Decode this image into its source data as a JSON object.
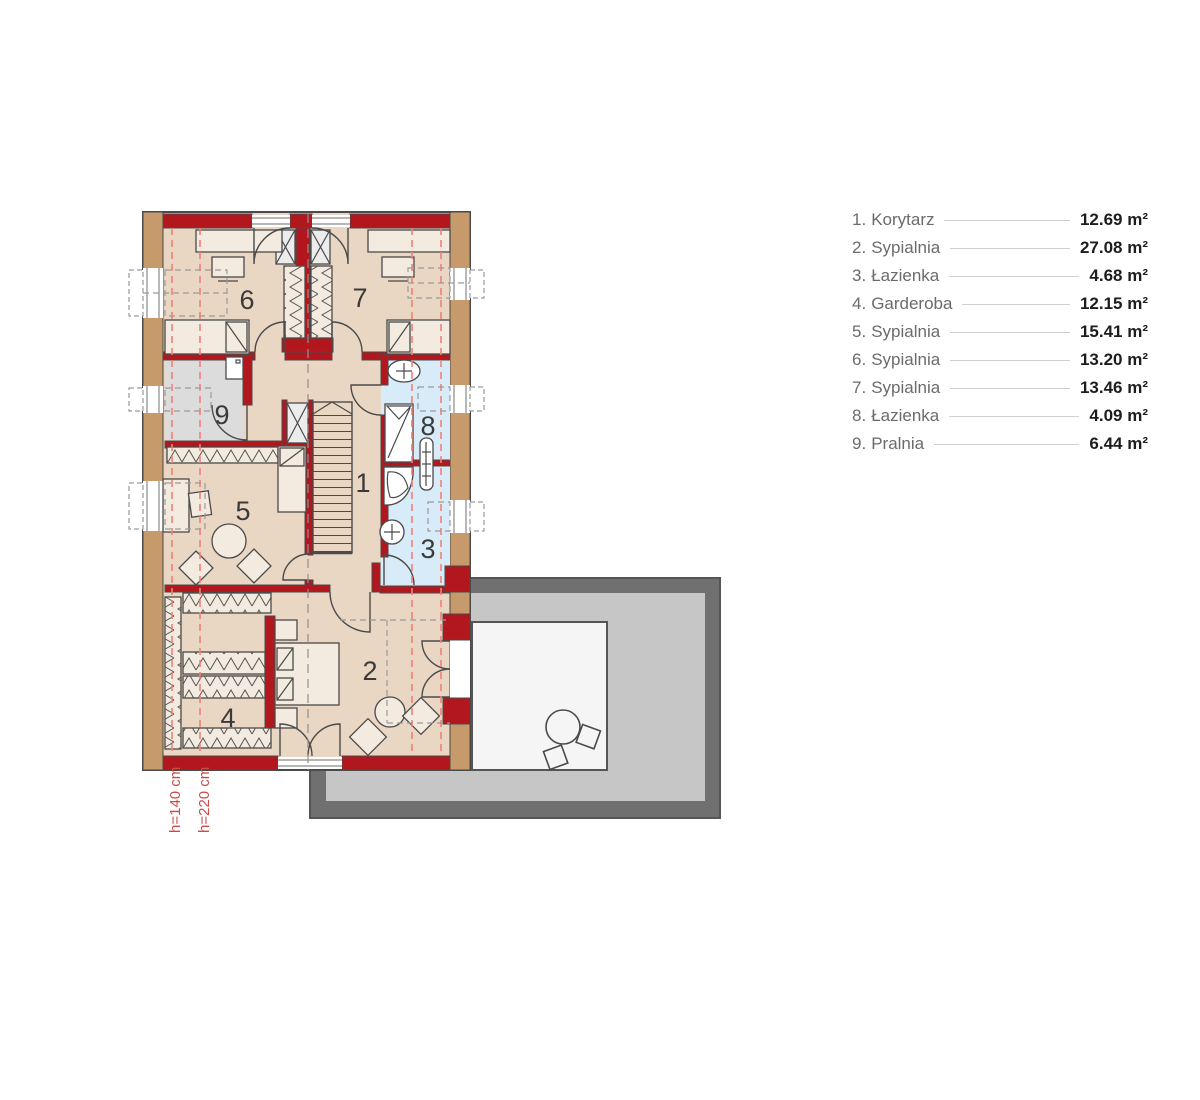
{
  "legend": {
    "items": [
      {
        "index": "1.",
        "name": "Korytarz",
        "area": "12.69 m²"
      },
      {
        "index": "2.",
        "name": "Sypialnia",
        "area": "27.08 m²"
      },
      {
        "index": "3.",
        "name": "Łazienka",
        "area": "4.68 m²"
      },
      {
        "index": "4.",
        "name": "Garderoba",
        "area": "12.15 m²"
      },
      {
        "index": "5.",
        "name": "Sypialnia",
        "area": "15.41 m²"
      },
      {
        "index": "6.",
        "name": "Sypialnia",
        "area": "13.20 m²"
      },
      {
        "index": "7.",
        "name": "Sypialnia",
        "area": "13.46 m²"
      },
      {
        "index": "8.",
        "name": "Łazienka",
        "area": "4.09 m²"
      },
      {
        "index": "9.",
        "name": "Pralnia",
        "area": "6.44 m²"
      }
    ]
  },
  "plan": {
    "room_numbers": {
      "r1": "1",
      "r2": "2",
      "r3": "3",
      "r4": "4",
      "r5": "5",
      "r6": "6",
      "r7": "7",
      "r8": "8",
      "r9": "9"
    },
    "height_labels": {
      "h140": "h=140 cm",
      "h220": "h=220 cm"
    },
    "colors": {
      "wall_red": "#b2171d",
      "floor": "#e9d7c4",
      "bath": "#d8ebf8",
      "laundry": "#dcdcdd",
      "wood": "#c79a6b",
      "terrace_dark": "#707070",
      "terrace_light": "#c6c6c6",
      "balcony_floor": "#f5f5f5",
      "dash_red": "#ef8178"
    }
  }
}
